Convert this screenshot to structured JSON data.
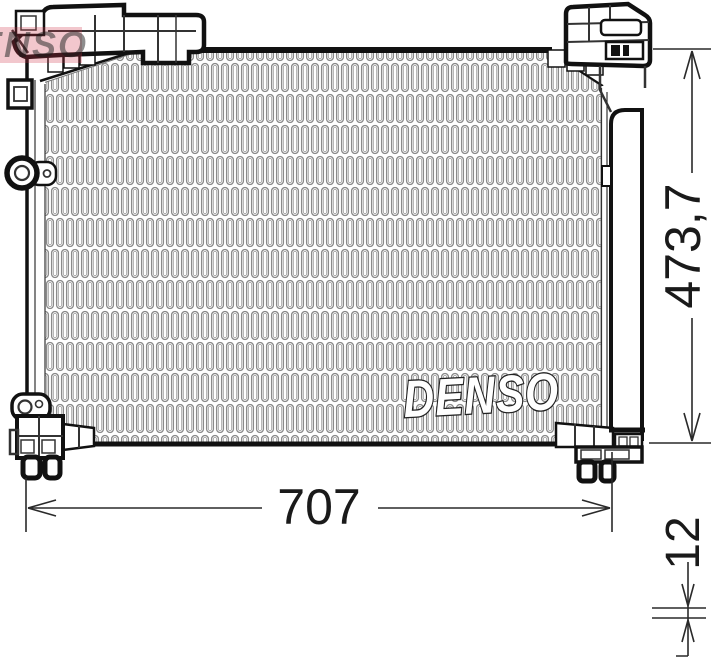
{
  "drawing": {
    "brand_watermark": "DENSO",
    "corner_watermark": "DENSO",
    "dimensions": {
      "height": "473,7",
      "width": "707",
      "depth": "12"
    }
  },
  "colors": {
    "line": "#1a1a1a",
    "fin_stroke": "#8a8a8a",
    "watermark_red": "#cc3344"
  }
}
